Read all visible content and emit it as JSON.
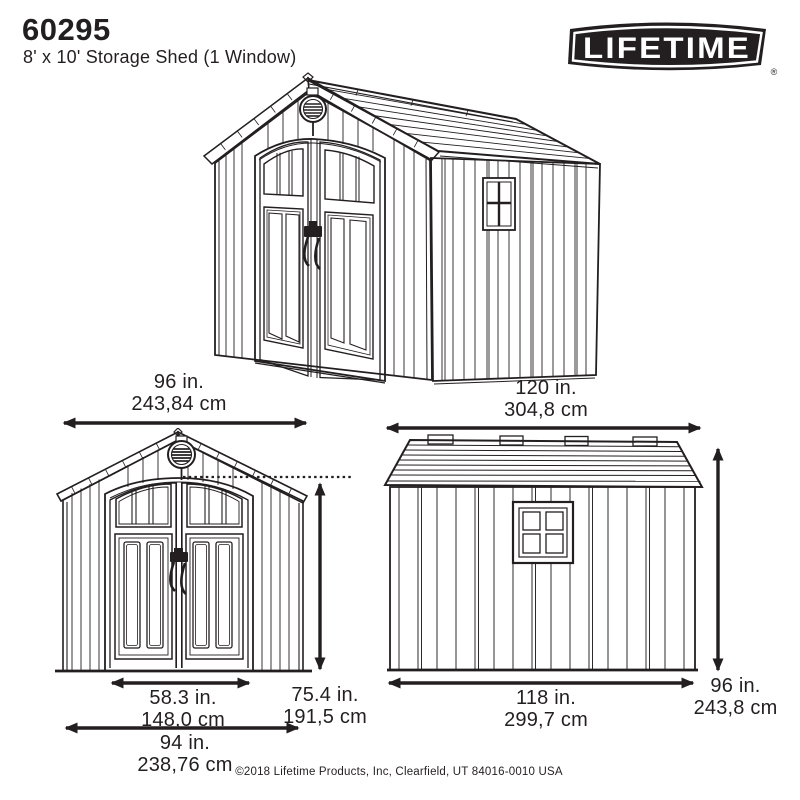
{
  "page": {
    "background": "#ffffff",
    "ink_color": "#231f20"
  },
  "header": {
    "model_number": "60295",
    "product_name": "8' x 10' Storage Shed (1 Window)"
  },
  "logo": {
    "brand": "LIFETIME",
    "registered_mark": "®"
  },
  "dimensions": {
    "front_overall_width": {
      "inches": "96 in.",
      "centimeters": "243,84 cm"
    },
    "roof_length": {
      "inches": "120 in.",
      "centimeters": "304,8 cm"
    },
    "door_opening_width": {
      "inches": "58.3 in.",
      "centimeters": "148,0 cm"
    },
    "wall_height": {
      "inches": "75.4 in.",
      "centimeters": "191,5 cm"
    },
    "base_width": {
      "inches": "94 in.",
      "centimeters": "238,76 cm"
    },
    "base_length": {
      "inches": "118 in.",
      "centimeters": "299,7 cm"
    },
    "overall_height": {
      "inches": "96 in.",
      "centimeters": "243,8 cm"
    }
  },
  "footer": {
    "copyright": "©2018 Lifetime Products, Inc, Clearfield, UT 84016-0010 USA"
  }
}
